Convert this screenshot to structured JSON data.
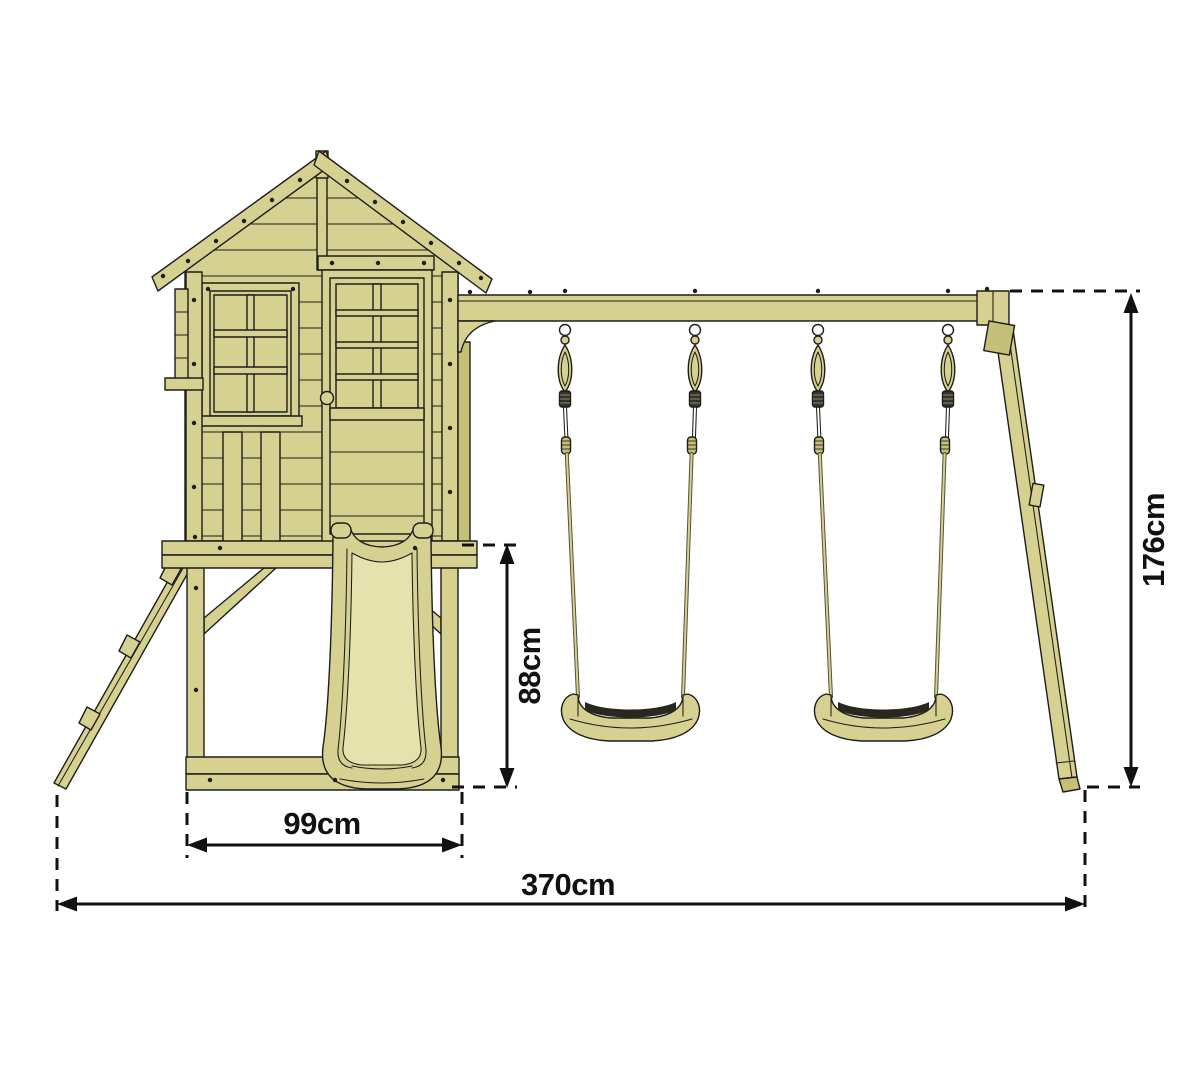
{
  "page": {
    "description": "Technical dimension drawing of a wooden playhouse tower with ladder, slide and a double swing set, front view"
  },
  "colors": {
    "background": "#ffffff",
    "wood": "#d6d190",
    "wood_dark": "#c5bf78",
    "wood_light": "#e6e2ae",
    "outline": "#1d1d1b",
    "grip": "#28281f",
    "rope_band": "#35342c",
    "dim": "#111111"
  },
  "dimensions": {
    "slide_platform_height": "88cm",
    "base_depth": "99cm",
    "total_width": "370cm",
    "swing_frame_height": "176cm"
  }
}
